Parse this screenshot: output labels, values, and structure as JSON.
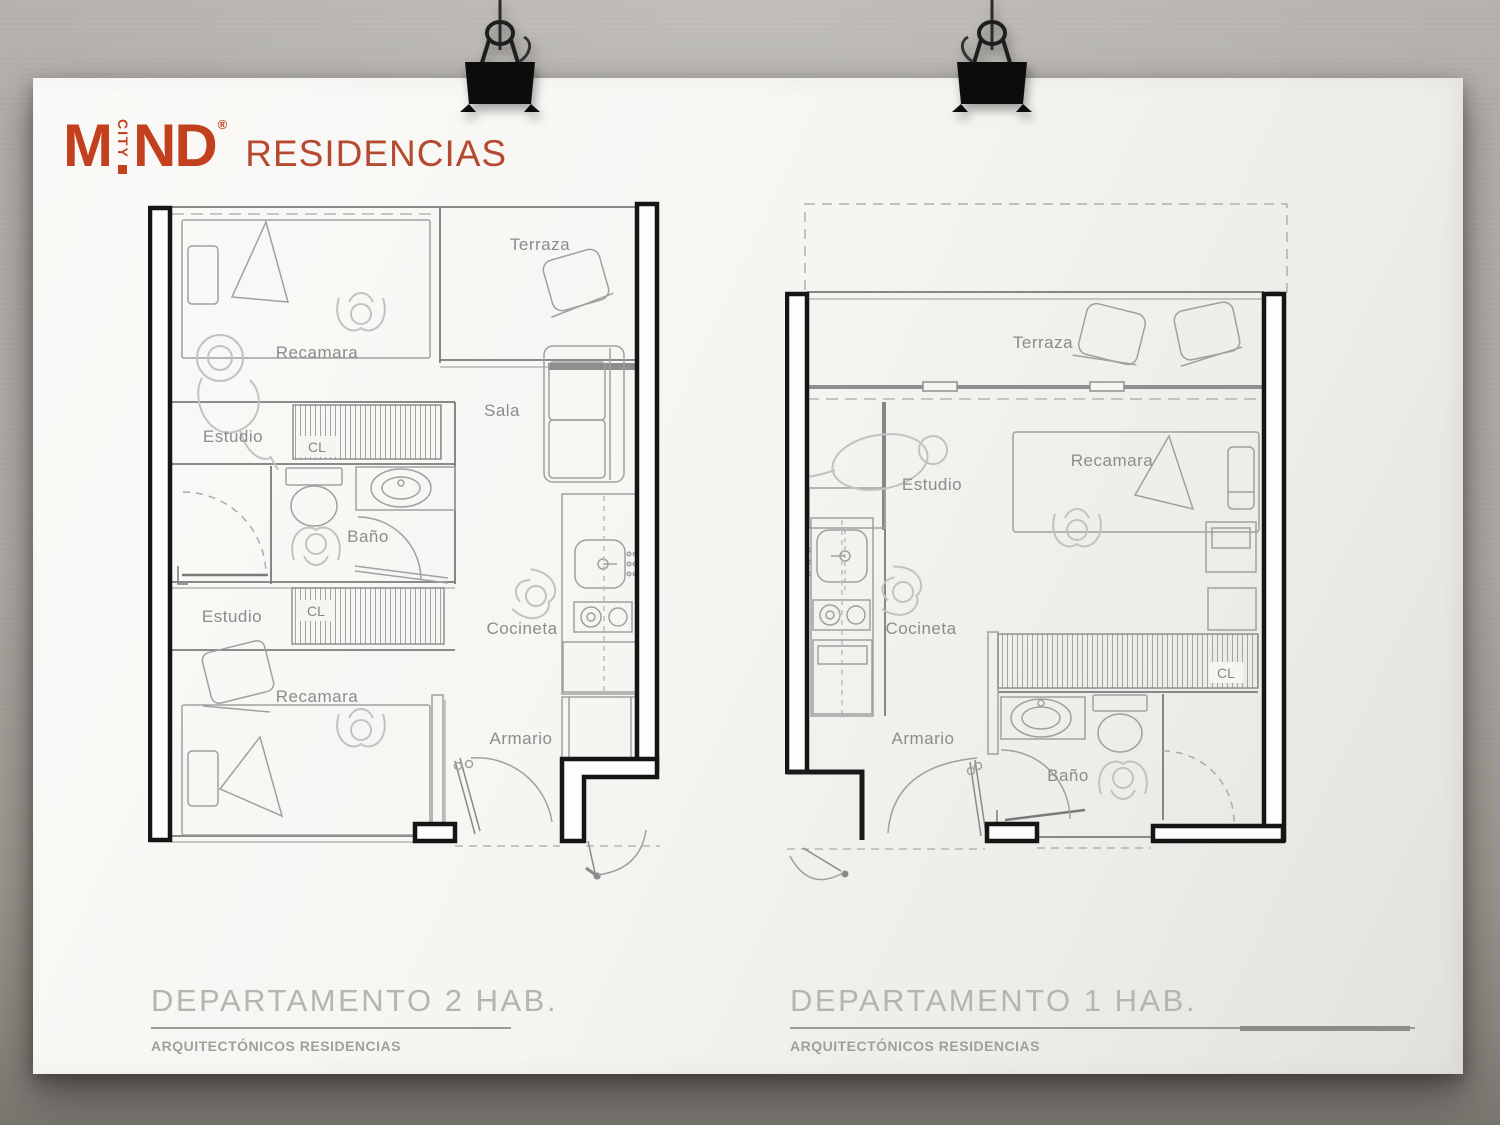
{
  "brand": {
    "m": "M",
    "vertical": "CITY",
    "nd": "ND",
    "registered": "®",
    "suffix": "RESIDENCIAS",
    "color": "#c2401d"
  },
  "plans": [
    {
      "title": "DEPARTAMENTO 2 HAB.",
      "subtitle": "ARQUITECTÓNICOS RESIDENCIAS",
      "labels": {
        "terraza": "Terraza",
        "recamara_top": "Recamara",
        "estudio_top": "Estudio",
        "cl_top": "CL",
        "sala": "Sala",
        "bano": "Baño",
        "estudio_bottom": "Estudio",
        "cl_bottom": "CL",
        "cocineta": "Cocineta",
        "recamara_bottom": "Recamara",
        "armario": "Armario"
      }
    },
    {
      "title": "DEPARTAMENTO 1 HAB.",
      "subtitle": "ARQUITECTÓNICOS RESIDENCIAS",
      "labels": {
        "terraza": "Terraza",
        "estudio": "Estudio",
        "recamara": "Recamara",
        "cocineta": "Cocineta",
        "cl": "CL",
        "armario": "Armario",
        "bano": "Baño"
      }
    }
  ],
  "decor": {
    "clip_icon": "binder-clip"
  }
}
